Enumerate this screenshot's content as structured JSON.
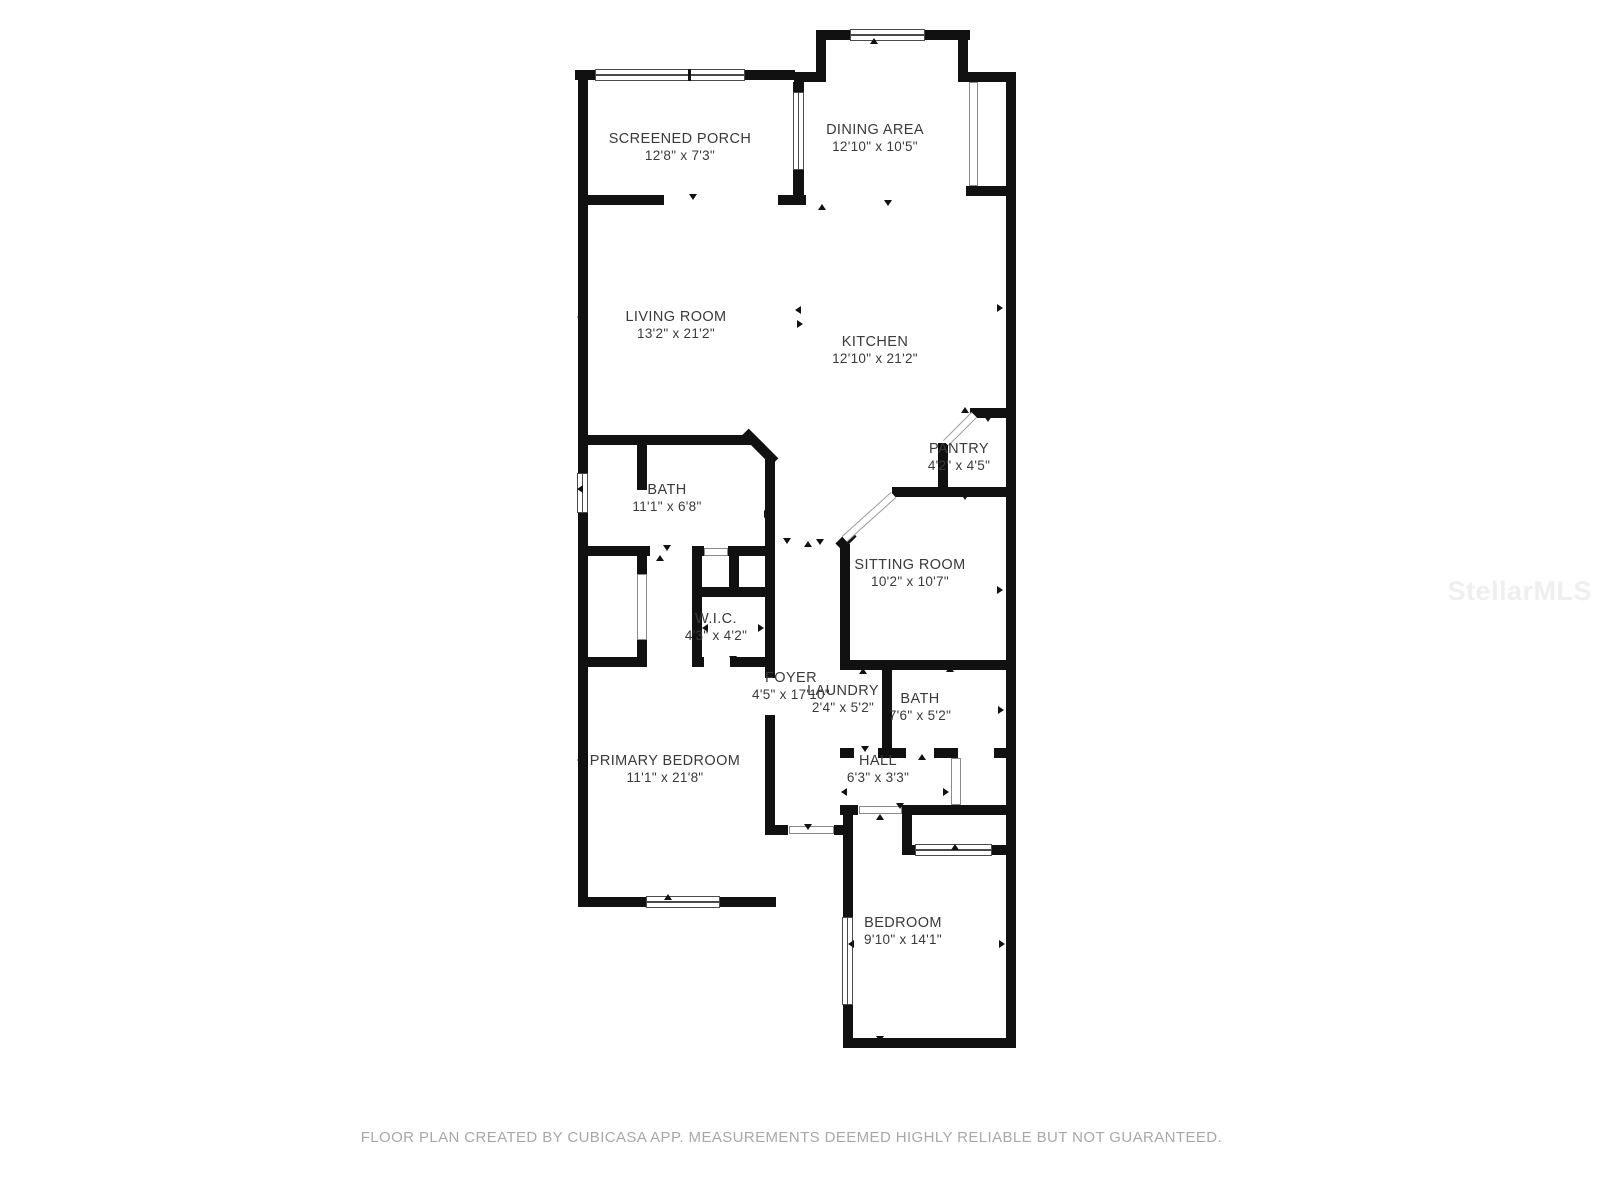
{
  "title": "Residential floor plan",
  "rooms": [
    {
      "id": "screened-porch",
      "name": "SCREENED PORCH",
      "dims": "12'8\" x 7'3\""
    },
    {
      "id": "dining-area",
      "name": "DINING AREA",
      "dims": "12'10\" x 10'5\""
    },
    {
      "id": "living-room",
      "name": "LIVING ROOM",
      "dims": "13'2\" x 21'2\""
    },
    {
      "id": "kitchen",
      "name": "KITCHEN",
      "dims": "12'10\" x 21'2\""
    },
    {
      "id": "bath-upper",
      "name": "BATH",
      "dims": "11'1\" x 6'8\""
    },
    {
      "id": "pantry",
      "name": "PANTRY",
      "dims": "4'2\" x 4'5\""
    },
    {
      "id": "sitting-room",
      "name": "SITTING ROOM",
      "dims": "10'2\" x 10'7\""
    },
    {
      "id": "wic",
      "name": "W.I.C.",
      "dims": "4'3\" x 4'2\""
    },
    {
      "id": "foyer",
      "name": "FOYER",
      "dims": "4'5\" x 17'10\""
    },
    {
      "id": "laundry",
      "name": "LAUNDRY",
      "dims": "2'4\" x 5'2\""
    },
    {
      "id": "bath-lower",
      "name": "BATH",
      "dims": "7'6\" x 5'2\""
    },
    {
      "id": "hall",
      "name": "HALL",
      "dims": "6'3\" x 3'3\""
    },
    {
      "id": "primary-bedroom",
      "name": "PRIMARY BEDROOM",
      "dims": "11'1\" x 21'8\""
    },
    {
      "id": "bedroom",
      "name": "BEDROOM",
      "dims": "9'10\" x 14'1\""
    }
  ],
  "footer": {
    "disclaimer": "FLOOR PLAN CREATED BY CUBICASA APP. MEASUREMENTS DEEMED HIGHLY RELIABLE BUT NOT GUARANTEED."
  },
  "watermark": {
    "text": "StellarMLS"
  },
  "colors": {
    "background": "#ffffff",
    "wall": "#111111",
    "room_label": "#3a3a3a",
    "footer_text": "#a8a8a8",
    "watermark_text": "#efefef"
  }
}
